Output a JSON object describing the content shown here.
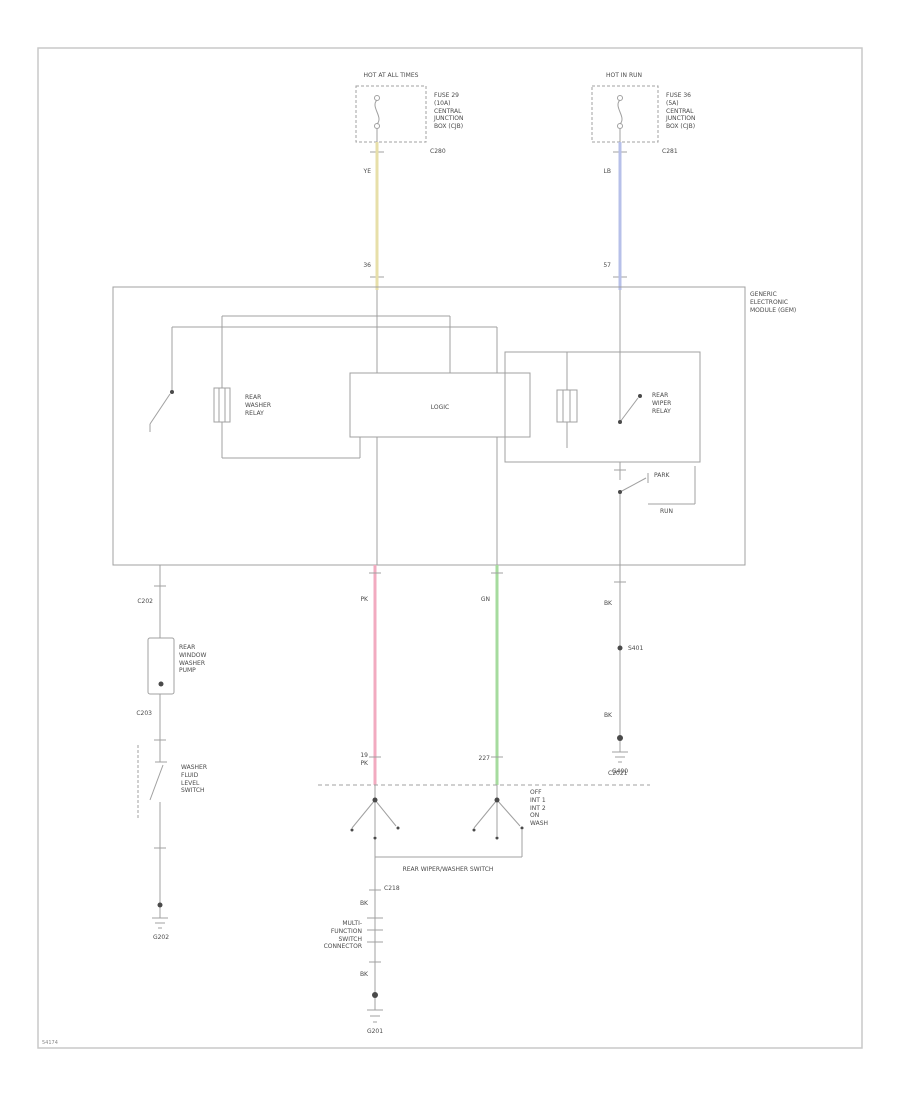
{
  "page": {
    "code": "54174"
  },
  "colors": {
    "wire_yellow": "#e7dfa9",
    "wire_blue": "#b7c0e9",
    "wire_pink": "#f2abc0",
    "wire_green": "#a6db9e",
    "line_gray": "#a0a0a0"
  },
  "power_left": {
    "header": "HOT AT ALL TIMES",
    "fuse_lines": [
      "FUSE 29",
      "(10A)",
      "CENTRAL",
      "JUNCTION",
      "BOX (CJB)"
    ],
    "connector": "C280",
    "wire_label": "YE",
    "circuit_label": "36"
  },
  "power_right": {
    "header": "HOT IN RUN",
    "fuse_lines": [
      "FUSE 36",
      "(5A)",
      "CENTRAL",
      "JUNCTION",
      "BOX (CJB)"
    ],
    "connector": "C281",
    "wire_label": "LB",
    "circuit_label": "57"
  },
  "module": {
    "name_lines": [
      "GENERIC",
      "ELECTRONIC",
      "MODULE (GEM)"
    ],
    "logic_label": "LOGIC",
    "washer_relay_lines": [
      "REAR",
      "WASHER",
      "RELAY"
    ],
    "wiper_relay_lines": [
      "REAR",
      "WIPER",
      "RELAY"
    ],
    "park_label": "PARK",
    "run_label": "RUN"
  },
  "left_branch": {
    "connector_top": "C202",
    "pump_lines": [
      "REAR",
      "WINDOW",
      "WASHER",
      "PUMP"
    ],
    "connector_mid": "C203",
    "switch_lines": [
      "WASHER",
      "FLUID",
      "LEVEL",
      "SWITCH"
    ],
    "ground": "G202"
  },
  "signals": {
    "pink_label_top": "PK",
    "pink_circuit": "19",
    "pink_label_bottom": "PK",
    "green_label_top": "GN",
    "green_label_bottom": "227",
    "boundary_connector": "C2021"
  },
  "switch_assembly": {
    "name": "REAR WIPER/WASHER SWITCH",
    "positions": [
      "OFF",
      "INT 1",
      "INT 2",
      "ON",
      "WASH"
    ]
  },
  "bottom_branch": {
    "connector": "C218",
    "wire_label_1": "BK",
    "inline_lines": [
      "MULTI-",
      "FUNCTION",
      "SWITCH",
      "CONNECTOR"
    ],
    "wire_label_2": "BK",
    "ground": "G201"
  },
  "right_branch": {
    "wire_label_1": "BK",
    "splice": "S401",
    "wire_label_2": "BK",
    "ground": "G400"
  }
}
